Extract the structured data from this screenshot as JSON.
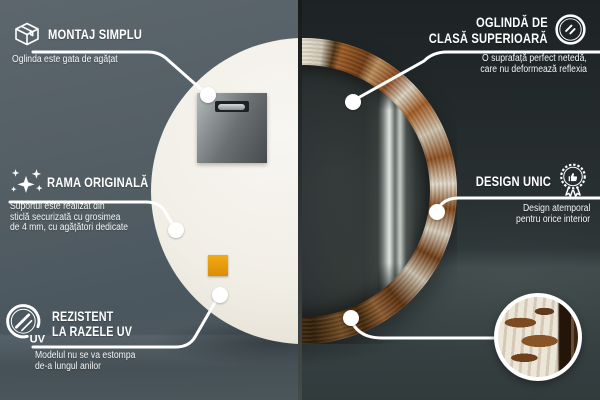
{
  "colors": {
    "wall_left": "#515d63",
    "wall_right": "#272d2f",
    "divider": "#2e3331",
    "mirror_back": "#f3f1ea",
    "frame_rust": "#8a4a1f",
    "frame_plaster": "#e3decf",
    "sticker_orange": "#eda315",
    "callout_line": "#ffffff"
  },
  "callouts": {
    "montaj": {
      "title": "MONTAJ SIMPLU",
      "subtitle": "Oglinda este gata de agățat"
    },
    "oglinda": {
      "title_line1": "OGLINDĂ DE",
      "title_line2": "CLASĂ SUPERIOARĂ",
      "subtitle_line1": "O suprafață perfect netedă,",
      "subtitle_line2": "care nu deformează reflexia"
    },
    "rama": {
      "title": "RAMA ORIGINALĂ",
      "subtitle_line1": "Suportul este realizat din",
      "subtitle_line2": "sticlă securizată cu grosimea",
      "subtitle_line3": "de 4 mm, cu agățători dedicate"
    },
    "design": {
      "title": "DESIGN UNIC",
      "subtitle_line1": "Design atemporal",
      "subtitle_line2": "pentru orice interior"
    },
    "uv": {
      "title_line1": "REZISTENT",
      "title_line2": "LA RAZELE UV",
      "subtitle_line1": "Modelul nu se va estompa",
      "subtitle_line2": "de-a lungul anilor",
      "icon_label": "UV"
    }
  }
}
